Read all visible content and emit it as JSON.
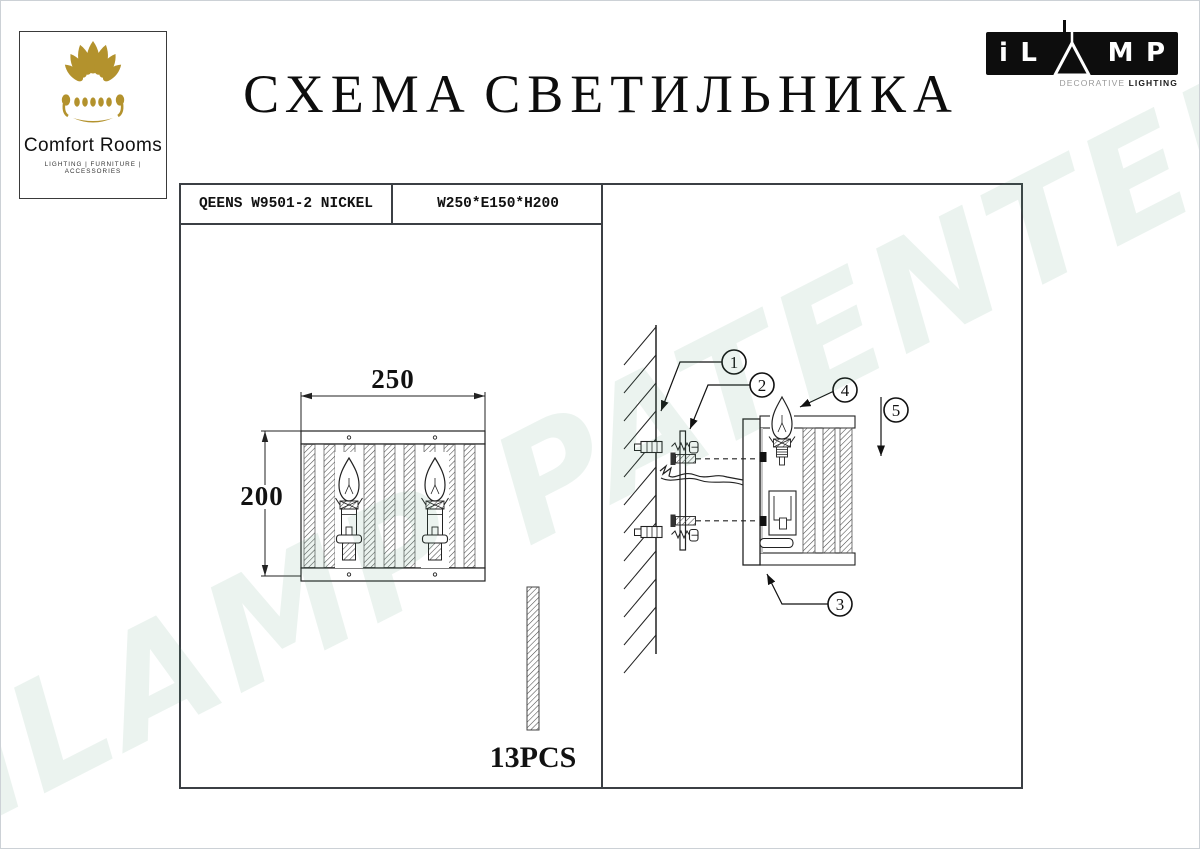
{
  "page": {
    "title": "СХЕМА СВЕТИЛЬНИКА",
    "watermark": "iLAMP PATENTED"
  },
  "logo_comfort": {
    "name": "Comfort Rooms",
    "tagline": "LIGHTING  |  FURNITURE  |  ACCESSORIES",
    "gold": "#b3922d"
  },
  "logo_ilamp": {
    "letter_i": "i",
    "letter_l": "L",
    "letter_m": "M",
    "letter_p": "P",
    "sub_light": "DECORATIVE ",
    "sub_bold": "LIGHTING"
  },
  "spec": {
    "model": "QEENS W9501-2 NICKEL",
    "size": "W250*E150*H200"
  },
  "front_view": {
    "width": "250",
    "height": "200",
    "pcs": "13PCS"
  },
  "callouts": {
    "c1": "1",
    "c2": "2",
    "c3": "3",
    "c4": "4",
    "c5": "5"
  },
  "colors": {
    "line": "#222222",
    "box_border": "#3b3f44",
    "gold": "#b3922d",
    "watermark_green": "#e9f4ee"
  }
}
